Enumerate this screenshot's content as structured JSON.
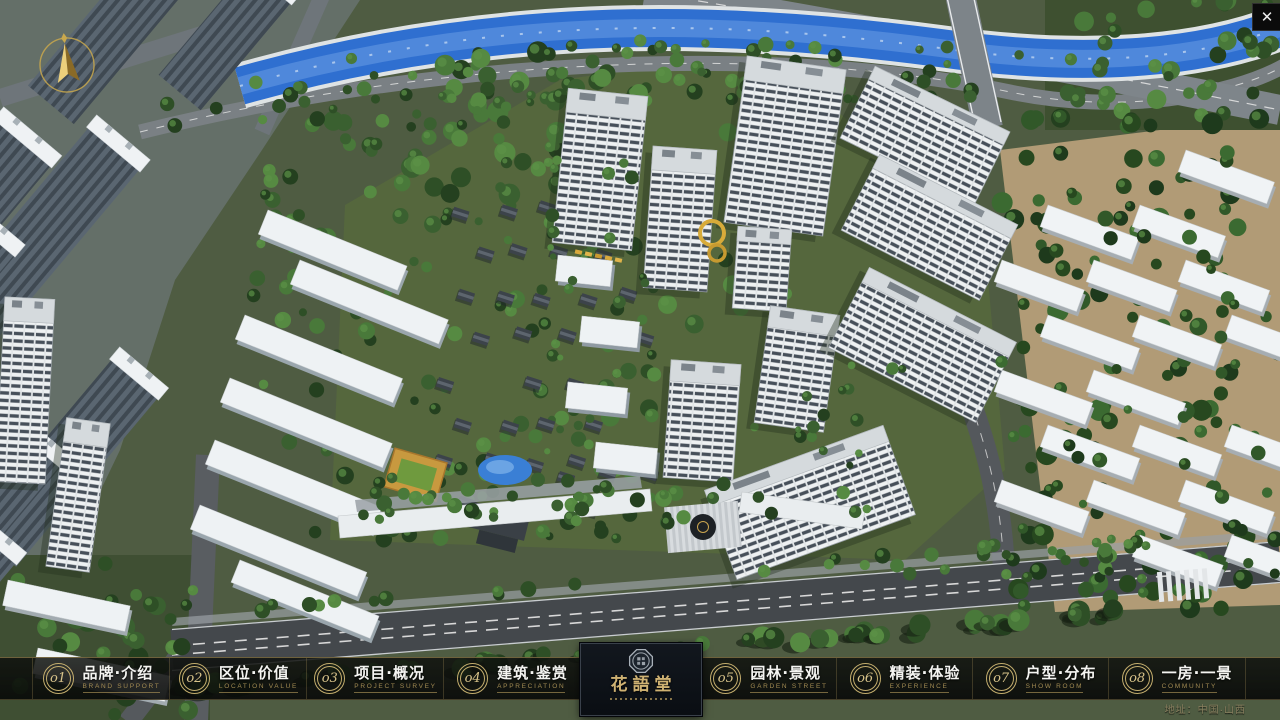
{
  "icons": {
    "close": "✕",
    "compass": "north-arrow",
    "logo_seal": "octagonal-seal"
  },
  "nav": {
    "items": [
      {
        "num": "o1",
        "label": "品牌·介绍",
        "sublabel": "BRAND SUPPORT"
      },
      {
        "num": "o2",
        "label": "区位·价值",
        "sublabel": "LOCATION VALUE"
      },
      {
        "num": "o3",
        "label": "项目·概况",
        "sublabel": "PROJECT SURVEY"
      },
      {
        "num": "o4",
        "label": "建筑·鉴赏",
        "sublabel": "APPRECIATION"
      },
      {
        "num": "o5",
        "label": "园林·景观",
        "sublabel": "GARDEN STREET"
      },
      {
        "num": "o6",
        "label": "精装·体验",
        "sublabel": "EXPERIENCE"
      },
      {
        "num": "o7",
        "label": "户型·分布",
        "sublabel": "SHOW ROOM"
      },
      {
        "num": "o8",
        "label": "一房·一景",
        "sublabel": "COMMUNITY"
      }
    ]
  },
  "logo": {
    "name": "花語堂"
  },
  "footer": {
    "address": "地址：中国·山西"
  },
  "colors": {
    "accent_gold": "#c4ae6e",
    "bar_background": "rgba(10,12,10,0.85)",
    "logo_panel_background": "#0b1016",
    "water_blue": "#2f6fd0",
    "tree_green": "#2e4f26"
  }
}
